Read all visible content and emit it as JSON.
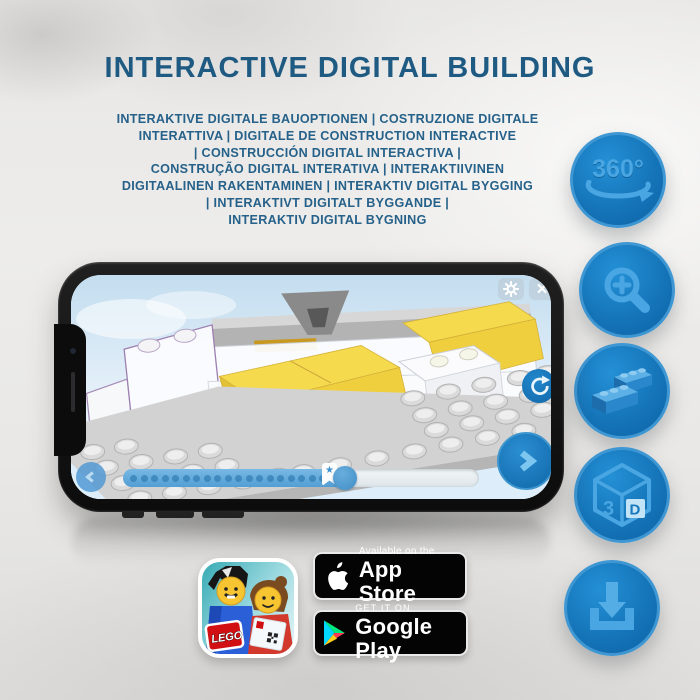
{
  "header": {
    "title": "INTERACTIVE DIGITAL BUILDING",
    "subtitle_lines": [
      "INTERAKTIVE DIGITALE BAUOPTIONEN | COSTRUZIONE DIGITALE",
      "INTERATTIVA | DIGITALE DE CONSTRUCTION INTERACTIVE",
      "| CONSTRUCCIÓN DIGITAL INTERACTIVA |",
      "CONSTRUÇÃO DIGITAL INTERATIVA | INTERAKTIIVINEN",
      "DIGITAALINEN RAKENTAMINEN | INTERAKTIV DIGITAL BYGGING",
      "| INTERAKTIVT DIGITALT BYGGANDE |",
      "INTERAKTIV DIGITAL BYGNING"
    ]
  },
  "features": {
    "rotate_label": "360°",
    "cube_left": "3",
    "cube_right": "D"
  },
  "phone_ui": {
    "close_icon": "×",
    "marker_star": "★",
    "slider": {
      "dot_count": 19
    }
  },
  "store": {
    "lego_logo": "LEGO",
    "app_store": {
      "tagline": "Available on the",
      "name": "App Store"
    },
    "google_play": {
      "tagline": "GET IT ON",
      "name": "Google Play"
    }
  },
  "colors": {
    "title_blue": "#1e5a82",
    "button_blue": "#1473b8",
    "button_glyph_blue": "#49a6e2",
    "brick_yellow": "#f5da4d",
    "lego_red": "#d01012",
    "badge_black": "#040404"
  }
}
